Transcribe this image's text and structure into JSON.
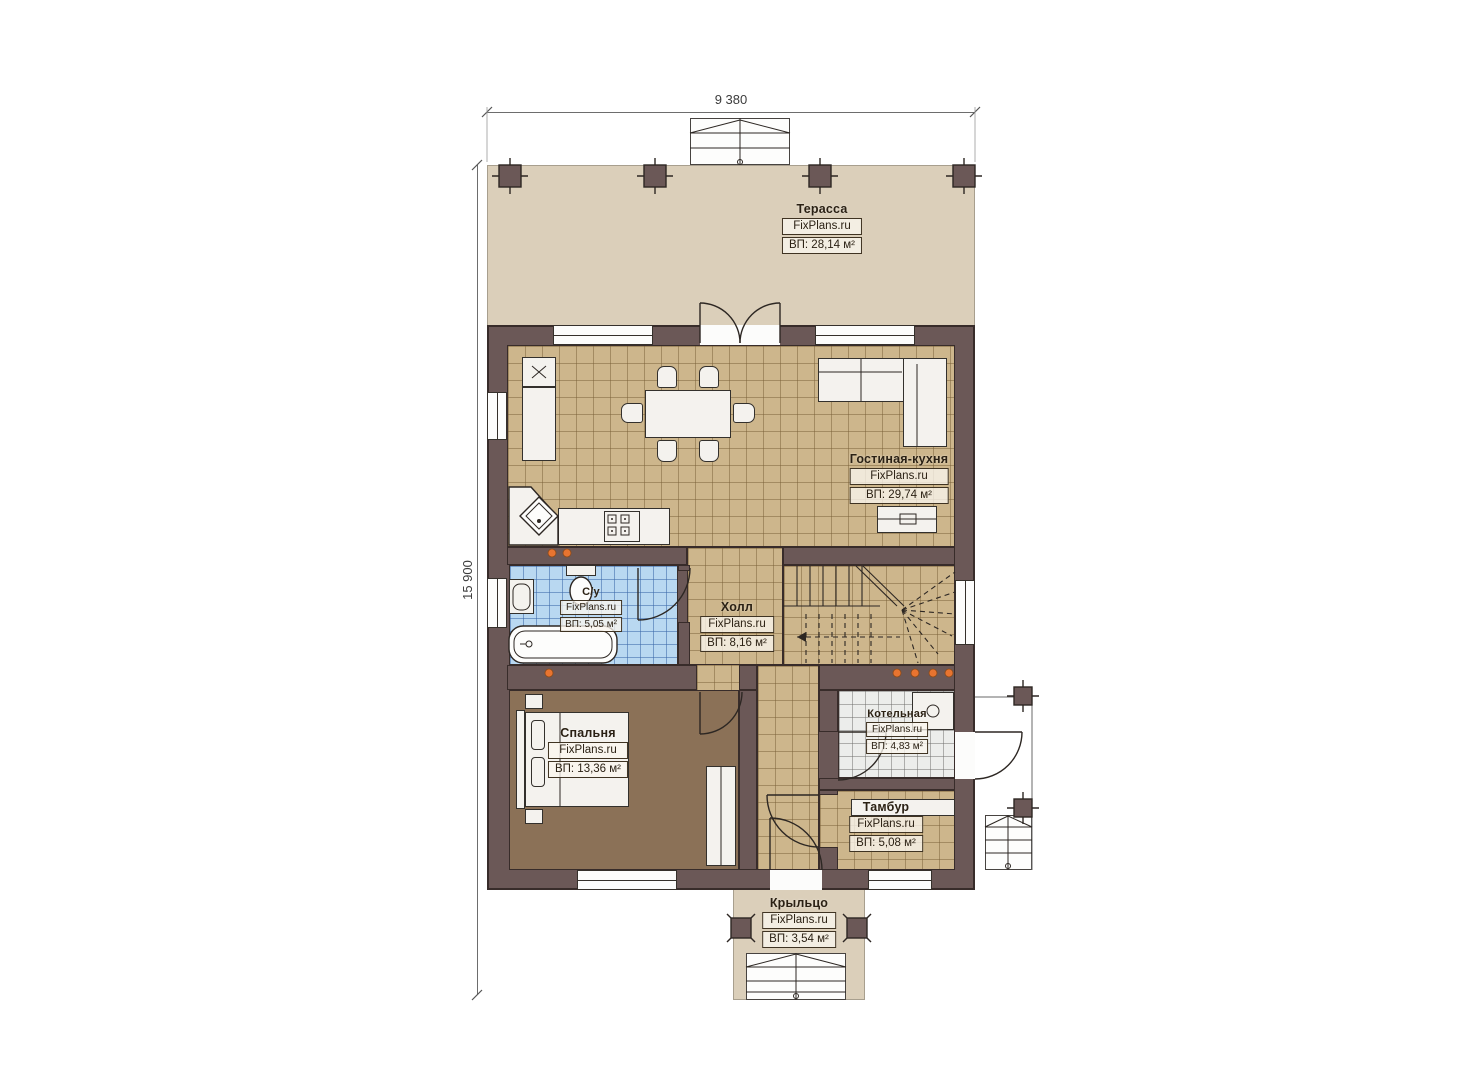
{
  "plan": {
    "title": "floor-plan",
    "dimensions": {
      "width_label": "9 380",
      "height_label": "15 900"
    },
    "rooms": [
      {
        "key": "terrace",
        "name": "Терасса",
        "brand": "FixPlans.ru",
        "area": "ВП: 28,14 м²"
      },
      {
        "key": "living_kitchen",
        "name": "Гостиная-кухня",
        "brand": "FixPlans.ru",
        "area": "ВП: 29,74 м²"
      },
      {
        "key": "bathroom",
        "name": "С/у",
        "brand": "FixPlans.ru",
        "area": "ВП: 5,05 м²"
      },
      {
        "key": "hall",
        "name": "Холл",
        "brand": "FixPlans.ru",
        "area": "ВП: 8,16 м²"
      },
      {
        "key": "bedroom",
        "name": "Спальня",
        "brand": "FixPlans.ru",
        "area": "ВП: 13,36 м²"
      },
      {
        "key": "boiler",
        "name": "Котельная",
        "brand": "FixPlans.ru",
        "area": "ВП: 4,83 м²"
      },
      {
        "key": "vestibule",
        "name": "Тамбур",
        "brand": "FixPlans.ru",
        "area": "ВП: 5,08 м²"
      },
      {
        "key": "porch",
        "name": "Крыльцо",
        "brand": "FixPlans.ru",
        "area": "ВП: 3,54 м²"
      }
    ],
    "colors": {
      "wall": "#6b5857",
      "floor_tile": "#cdb68c",
      "floor_bath": "#b9d8f1",
      "floor_boiler": "#ecedeb",
      "floor_bedroom": "#8b7157",
      "deck": "#dbcfba",
      "accent_dot": "#e87430"
    }
  }
}
